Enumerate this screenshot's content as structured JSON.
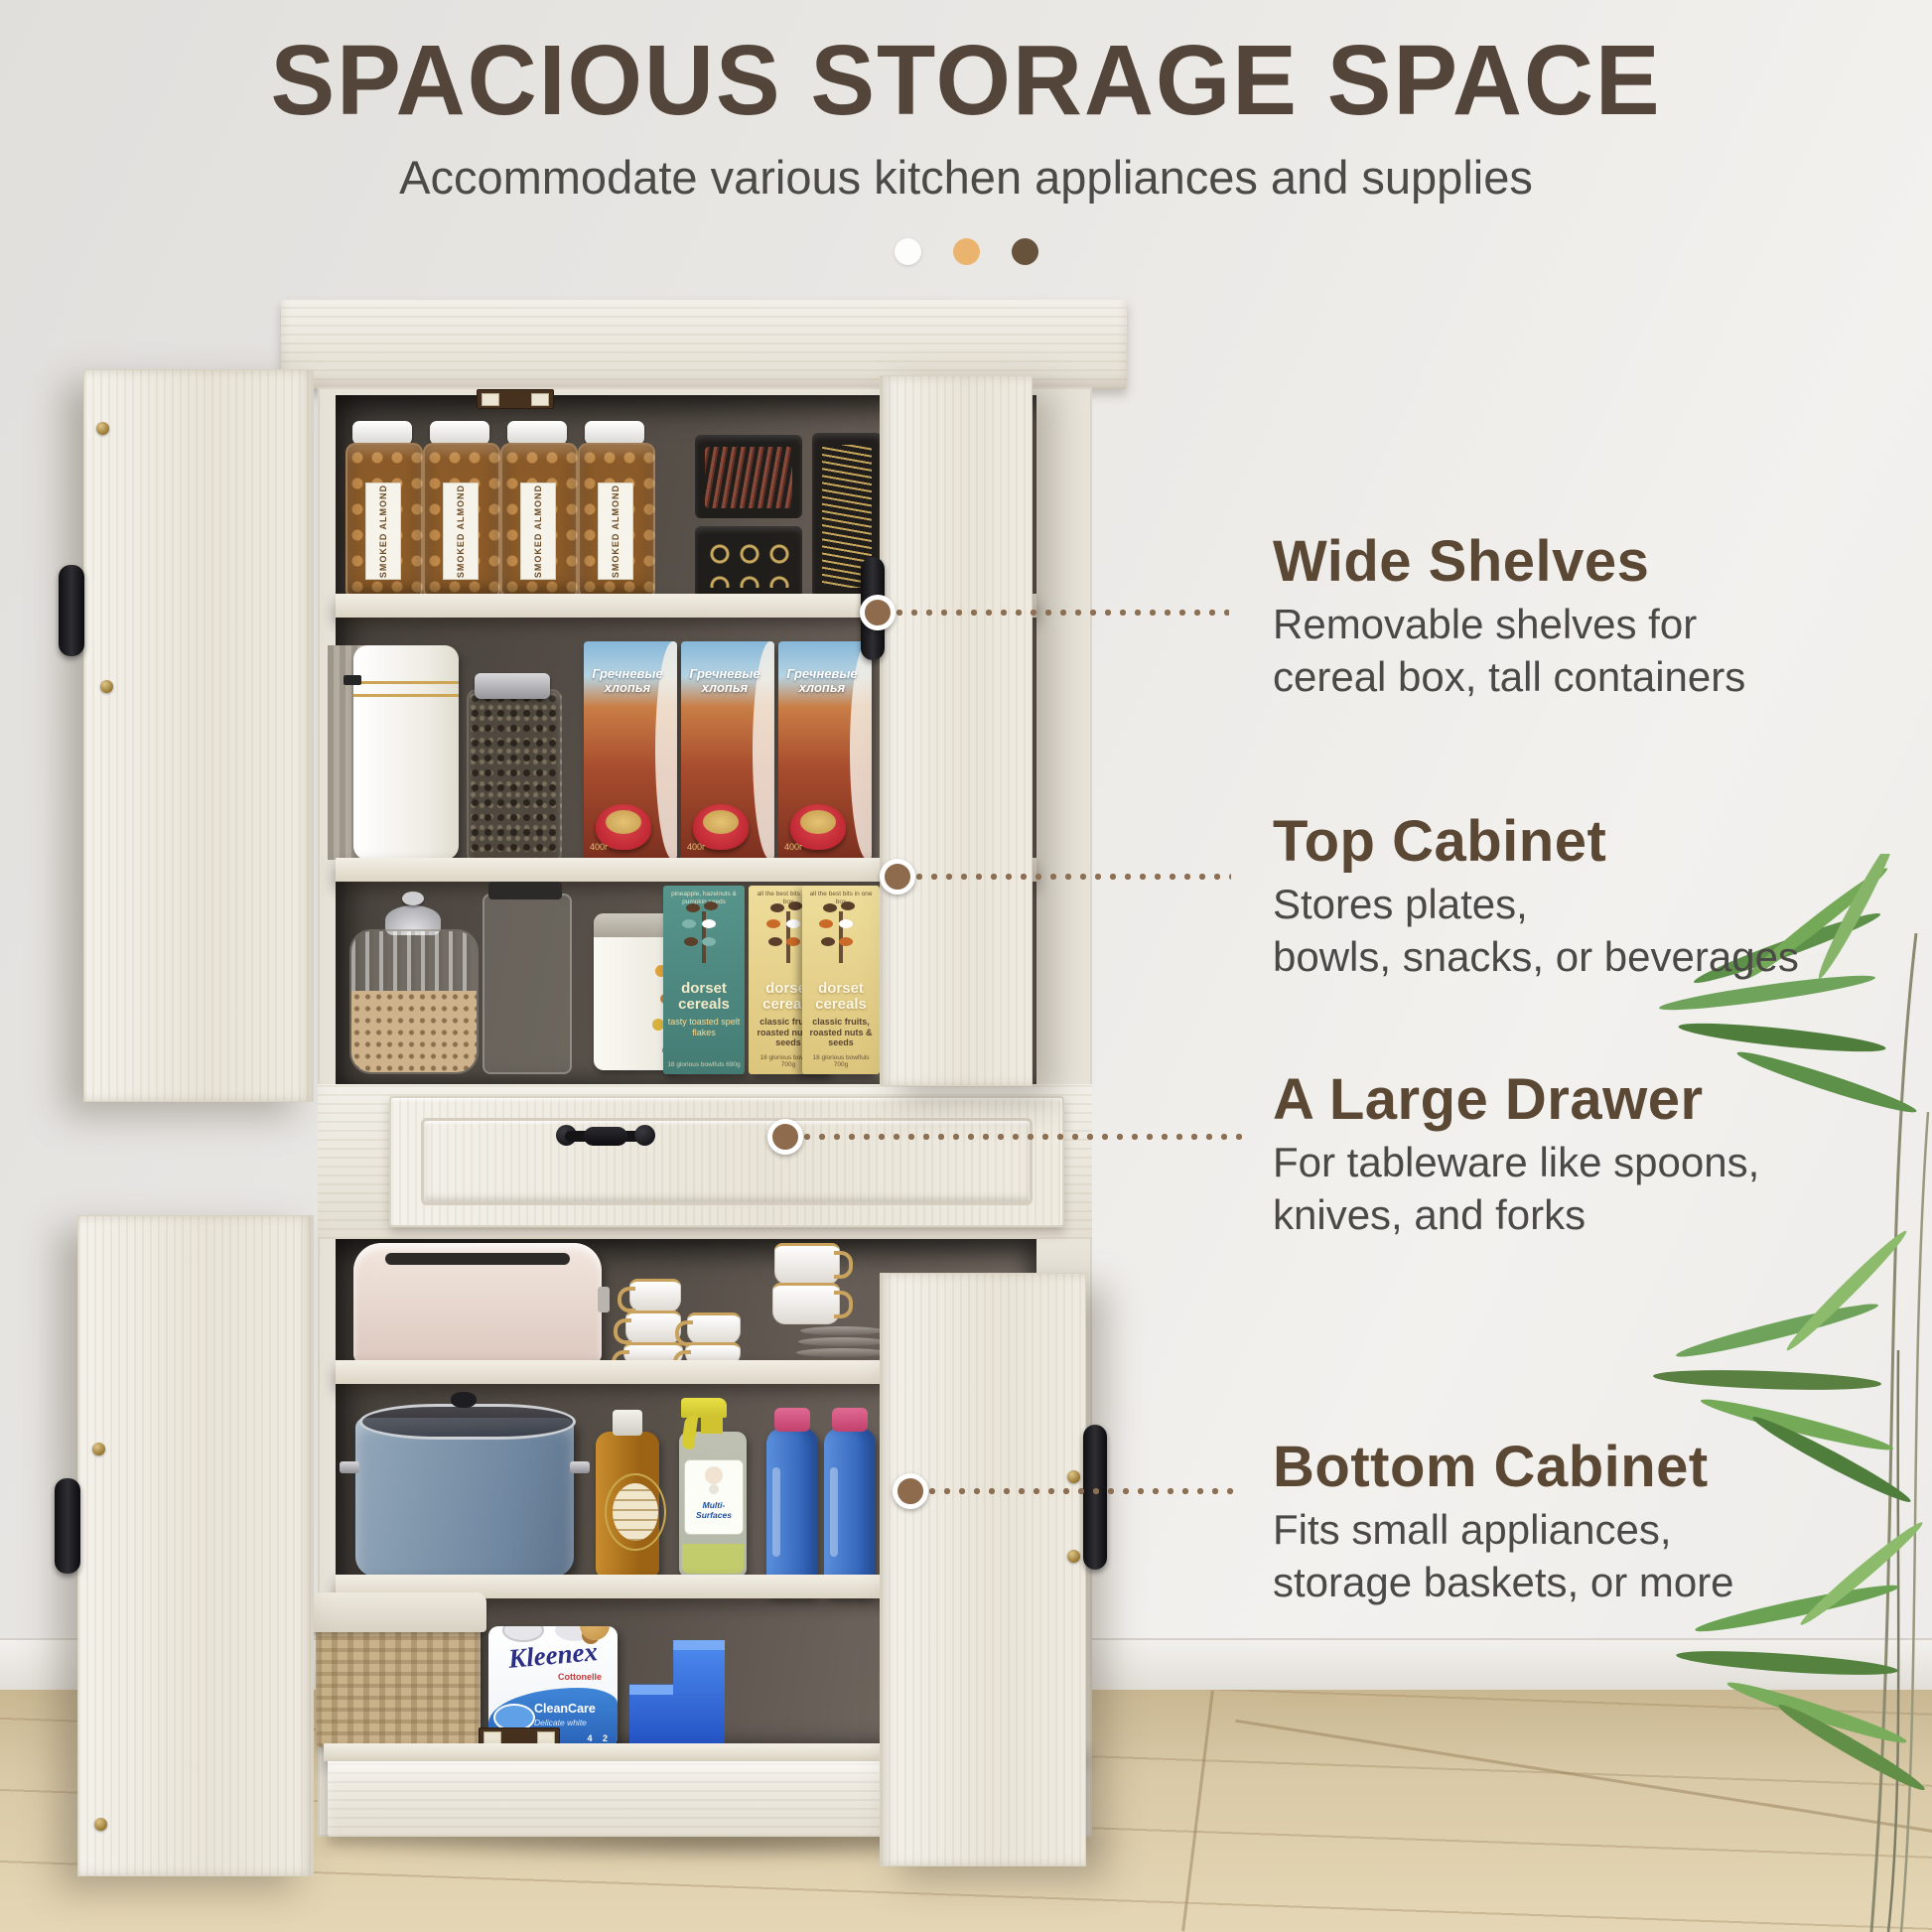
{
  "header": {
    "title": "SPACIOUS STORAGE SPACE",
    "subtitle": "Accommodate various kitchen appliances and supplies",
    "dots": [
      {
        "name": "white",
        "color": "#fdfdfb"
      },
      {
        "name": "tan",
        "color": "#eab46f"
      },
      {
        "name": "brown",
        "color": "#67523c"
      }
    ]
  },
  "callouts": [
    {
      "heading": "Wide Shelves",
      "lines": [
        "Removable shelves for",
        "cereal box, tall containers"
      ]
    },
    {
      "heading": "Top Cabinet",
      "lines": [
        "Stores plates,",
        "bowls, snacks, or beverages"
      ]
    },
    {
      "heading": "A Large Drawer",
      "lines": [
        "For tableware like spoons,",
        "knives, and forks"
      ]
    },
    {
      "heading": "Bottom Cabinet",
      "lines": [
        "Fits small appliances,",
        "storage baskets, or more"
      ]
    }
  ],
  "products": {
    "almond_jar": "SMOKED ALMOND",
    "cereal_box": {
      "title": "Гречневые хлопья",
      "weight": "400г"
    },
    "dorset_teal": {
      "brand": "dorset cereals",
      "variant": "tasty toasted spelt flakes",
      "top_note": "pineapple, hazelnuts & pumpkin seeds",
      "bottom_note": "18 glorious bowlfuls 690g"
    },
    "dorset_yellow": {
      "brand": "dorset cereals",
      "variant": "classic fruits, roasted nuts & seeds",
      "top_note": "all the best bits in one box",
      "bottom_note": "18 glorious bowlfuls 700g"
    },
    "kleenex": {
      "brand": "Kleenex",
      "sub": "Cottonelle",
      "line1": "CleanCare",
      "line2": "Delicate white",
      "counts": "4  2"
    },
    "spray": {
      "label": "Multi-Surfaces"
    }
  },
  "colors": {
    "heading_brown": "#5a4734",
    "body_gray": "#4b4946",
    "leader_brown": "#8d6f54",
    "door_cream": "#f0ece2",
    "interior_dark": "#57504a",
    "floor_wood": "#d9c9a7",
    "dorset_teal": "#4e8b83",
    "dorset_yellow": "#e9d890"
  }
}
